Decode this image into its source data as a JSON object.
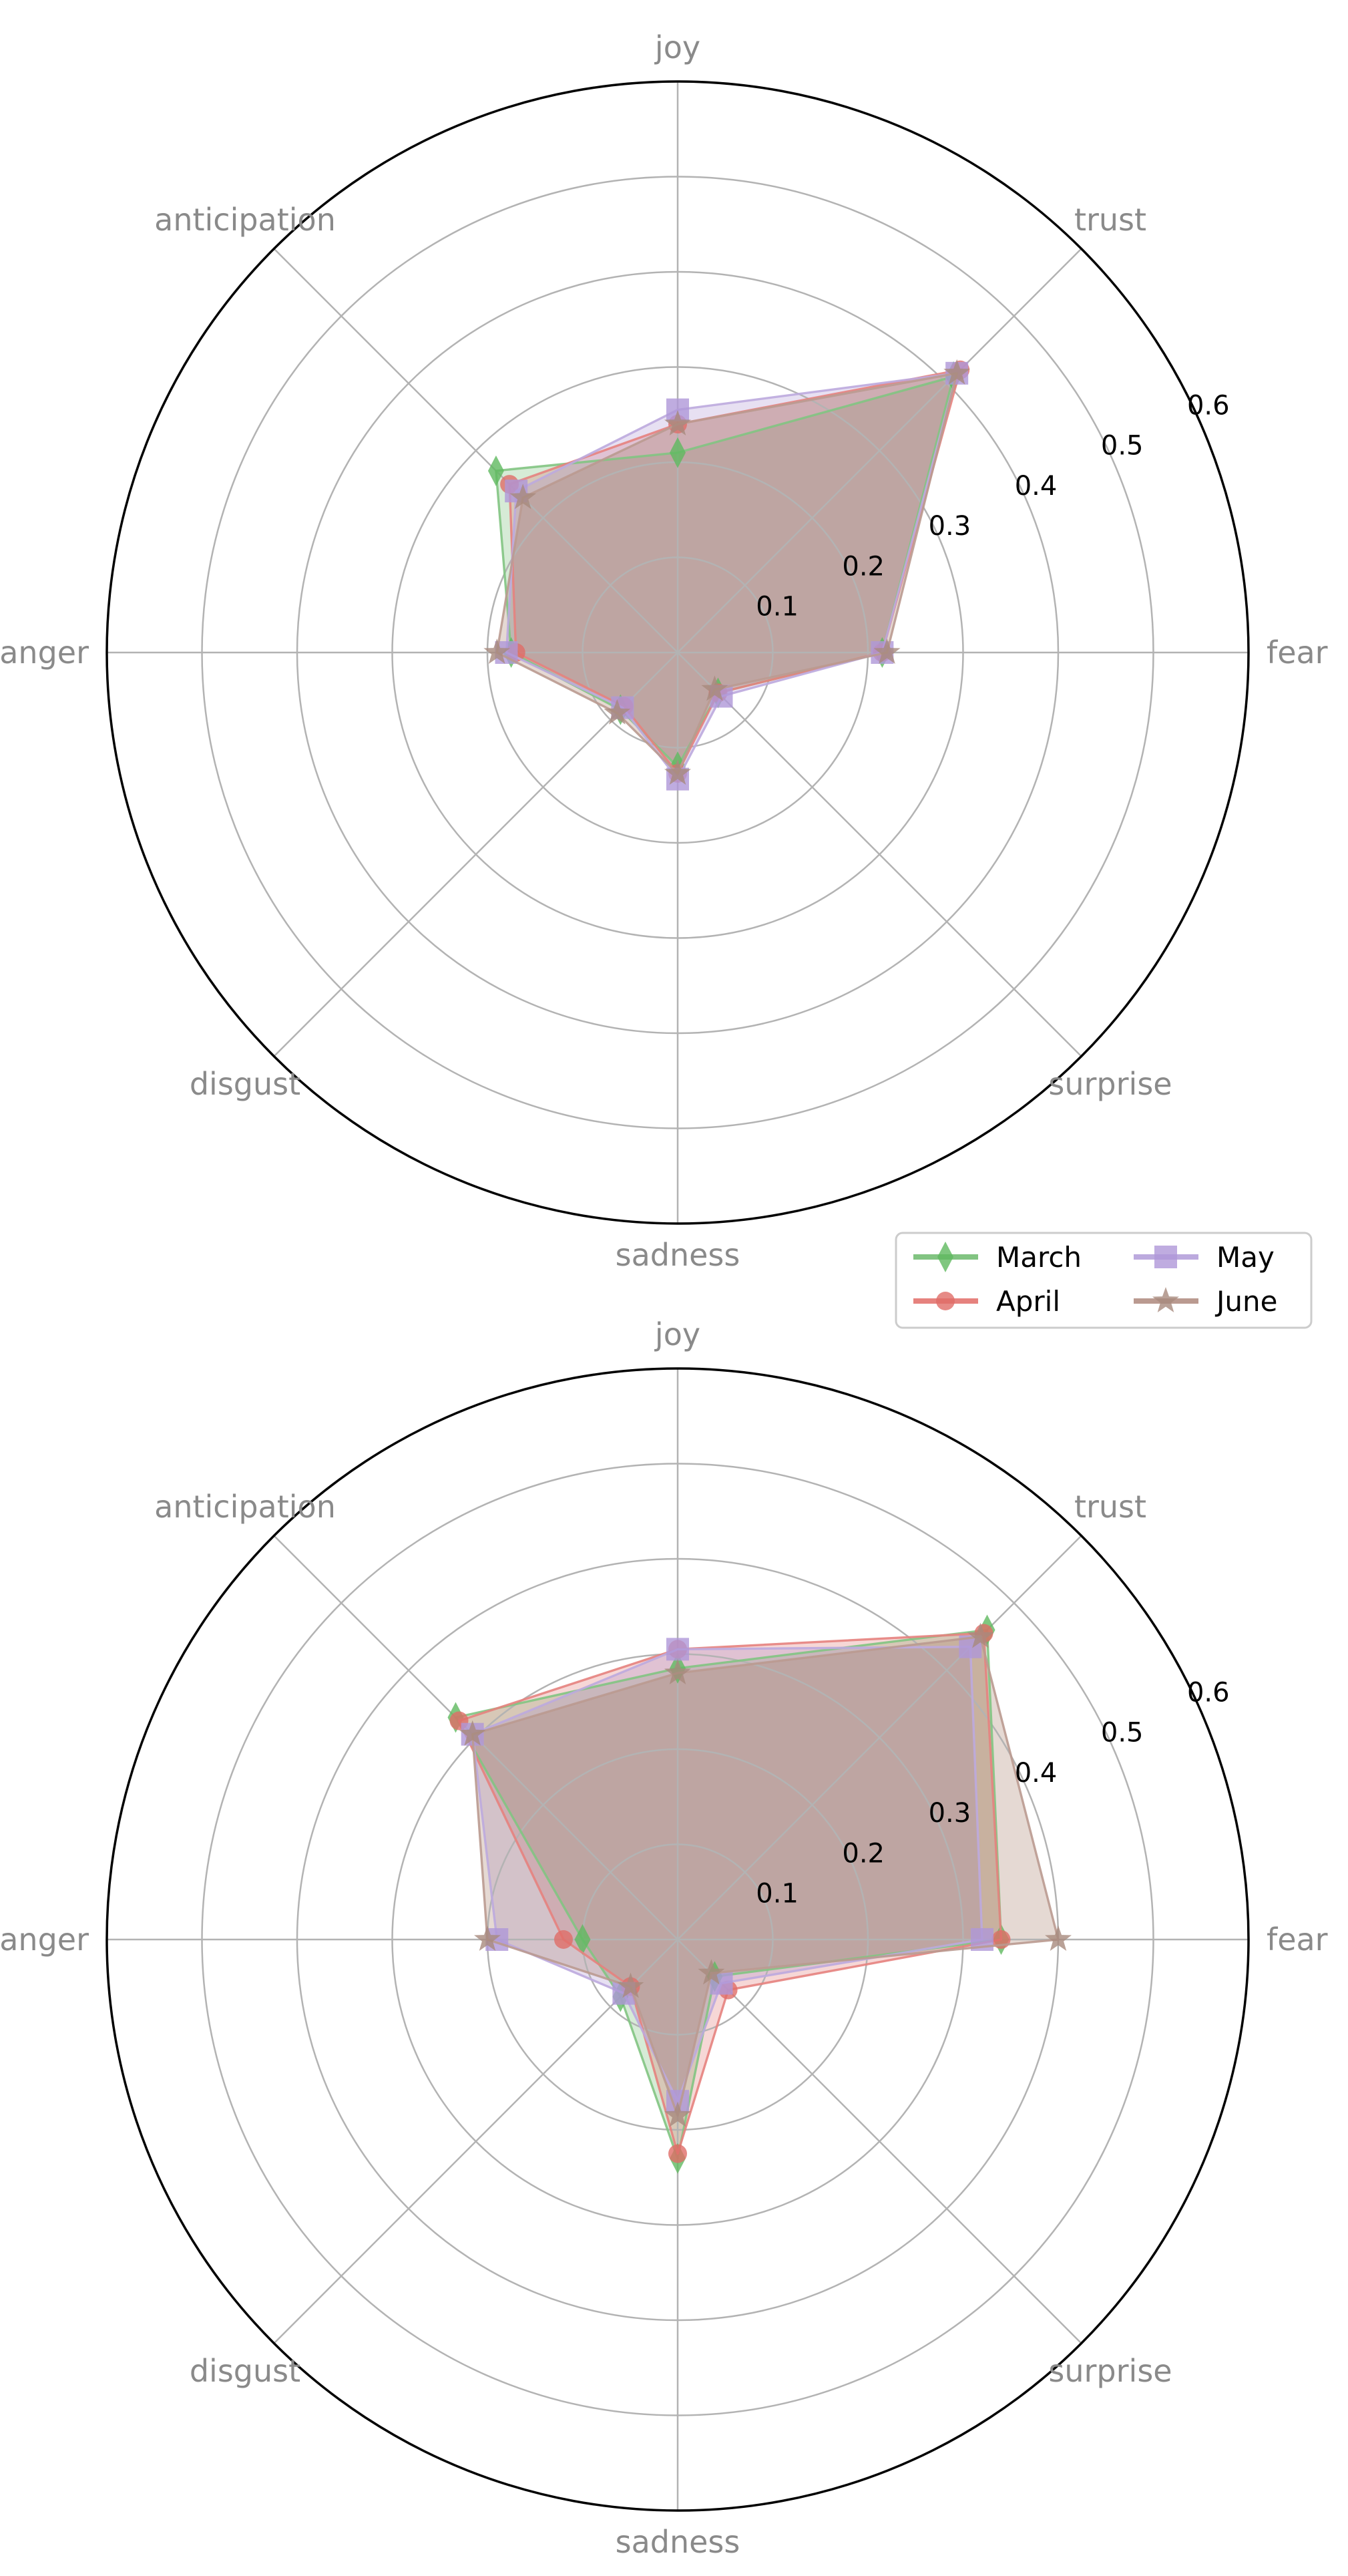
{
  "figure": {
    "background": "#ffffff",
    "grid_color": "#b3b3b3",
    "spine_color": "#000000",
    "axis_label_color": "#8a8a8a",
    "tick_label_color": "#000000"
  },
  "legend": {
    "border_color": "#cccccc",
    "items": [
      {
        "label": "March",
        "marker": "diamond",
        "line_color": "#82c482",
        "marker_color": "#5fb95f",
        "fill_color": "rgba(90,175,90,0.25)"
      },
      {
        "label": "April",
        "marker": "circle",
        "line_color": "#e6827e",
        "marker_color": "#e06d68",
        "fill_color": "rgba(220,95,90,0.25)"
      },
      {
        "label": "May",
        "marker": "square",
        "line_color": "#bcaade",
        "marker_color": "#af97d8",
        "fill_color": "rgba(160,130,205,0.25)"
      },
      {
        "label": "June",
        "marker": "star",
        "line_color": "#ba9a90",
        "marker_color": "#a8897d",
        "fill_color": "rgba(160,118,98,0.28)"
      }
    ]
  },
  "chart_data": [
    {
      "type": "radar",
      "title": "",
      "categories": [
        "joy",
        "trust",
        "fear",
        "surprise",
        "sadness",
        "disgust",
        "anger",
        "anticipation"
      ],
      "tick_labels": [
        "0.1",
        "0.2",
        "0.3",
        "0.4",
        "0.5",
        "0.6"
      ],
      "rmax": 0.6,
      "grid": true,
      "legend_position": "below-right",
      "series": [
        {
          "name": "March",
          "values": [
            0.21,
            0.41,
            0.215,
            0.06,
            0.12,
            0.085,
            0.175,
            0.27
          ]
        },
        {
          "name": "April",
          "values": [
            0.24,
            0.42,
            0.215,
            0.06,
            0.127,
            0.08,
            0.17,
            0.25
          ]
        },
        {
          "name": "May",
          "values": [
            0.255,
            0.415,
            0.215,
            0.065,
            0.133,
            0.082,
            0.18,
            0.24
          ]
        },
        {
          "name": "June",
          "values": [
            0.24,
            0.415,
            0.22,
            0.055,
            0.127,
            0.09,
            0.19,
            0.23
          ]
        }
      ]
    },
    {
      "type": "radar",
      "title": "",
      "categories": [
        "joy",
        "trust",
        "fear",
        "surprise",
        "sadness",
        "disgust",
        "anger",
        "anticipation"
      ],
      "tick_labels": [
        "0.1",
        "0.2",
        "0.3",
        "0.4",
        "0.5",
        "0.6"
      ],
      "rmax": 0.6,
      "grid": true,
      "legend_position": "none",
      "series": [
        {
          "name": "March",
          "values": [
            0.285,
            0.46,
            0.34,
            0.055,
            0.23,
            0.085,
            0.1,
            0.33
          ]
        },
        {
          "name": "April",
          "values": [
            0.305,
            0.455,
            0.34,
            0.075,
            0.225,
            0.07,
            0.12,
            0.325
          ]
        },
        {
          "name": "May",
          "values": [
            0.305,
            0.435,
            0.32,
            0.065,
            0.17,
            0.08,
            0.19,
            0.305
          ]
        },
        {
          "name": "June",
          "values": [
            0.28,
            0.45,
            0.4,
            0.05,
            0.185,
            0.07,
            0.2,
            0.305
          ]
        }
      ]
    }
  ]
}
